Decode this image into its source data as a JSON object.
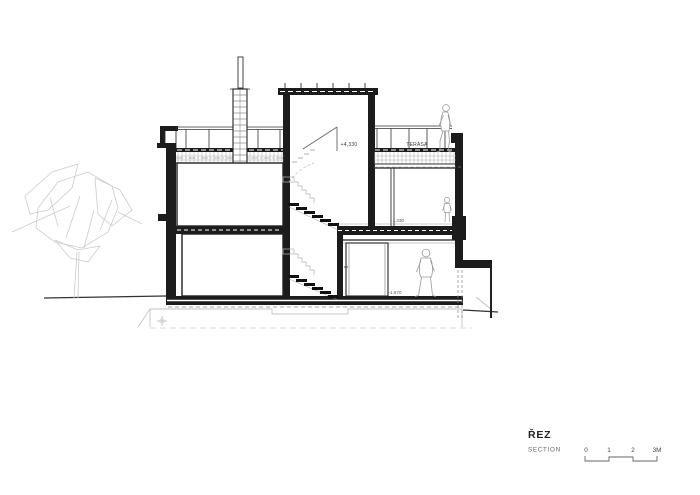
{
  "title_block": {
    "title": "ŘEZ",
    "subtitle": "SECTION"
  },
  "scale_bar": {
    "ticks": [
      "0",
      "1",
      "2",
      "3M"
    ]
  },
  "annotations": {
    "terrace_elevation": "+4,330",
    "terrace_name": "TERASA",
    "middle_floor_elevation": "+1,330",
    "lower_floor_elevation": "-1,670"
  },
  "colors": {
    "ink": "#1c1c1c",
    "mid_gray": "#555555",
    "light_gray": "#c4c4c4",
    "background": "#ffffff"
  }
}
